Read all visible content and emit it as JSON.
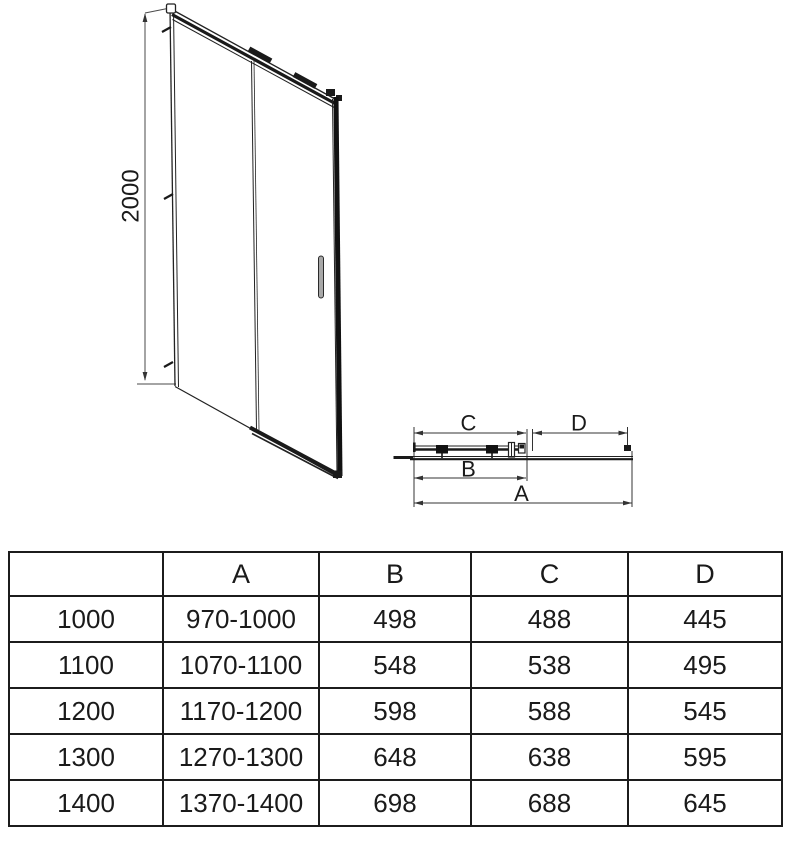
{
  "diagram": {
    "front_view": {
      "height_label": "2000"
    },
    "plan_view": {
      "dim_c": "C",
      "dim_d": "D",
      "dim_b": "B",
      "dim_a": "A"
    }
  },
  "table": {
    "headers": [
      "",
      "A",
      "B",
      "C",
      "D"
    ],
    "rows": [
      [
        "1000",
        "970-1000",
        "498",
        "488",
        "445"
      ],
      [
        "1100",
        "1070-1100",
        "548",
        "538",
        "495"
      ],
      [
        "1200",
        "1170-1200",
        "598",
        "588",
        "545"
      ],
      [
        "1300",
        "1270-1300",
        "648",
        "638",
        "595"
      ],
      [
        "1400",
        "1370-1400",
        "698",
        "688",
        "645"
      ]
    ]
  },
  "colors": {
    "line": "#1f1f1f",
    "dimension_line": "#4a4a4a",
    "handle_fill": "#a8a8a8",
    "table_border": "#1c1c1c",
    "background": "#ffffff"
  }
}
